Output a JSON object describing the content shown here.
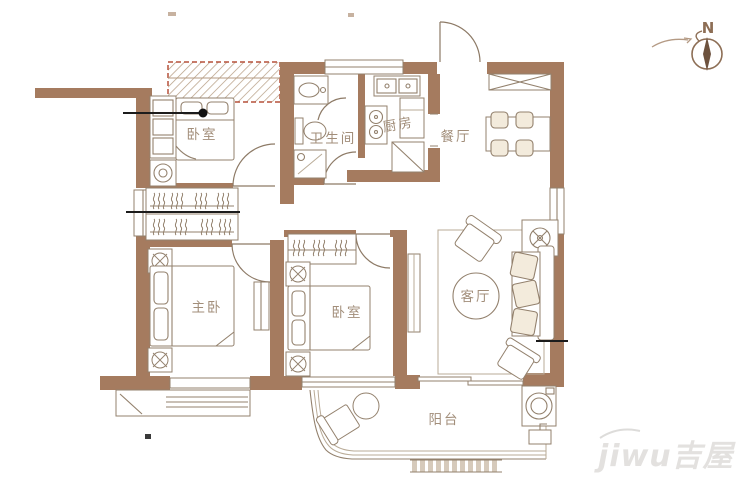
{
  "rooms": {
    "bedroom_top": {
      "label": "卧室"
    },
    "bathroom": {
      "label": "卫生间"
    },
    "kitchen": {
      "label": "厨房"
    },
    "dining": {
      "label": "餐厅"
    },
    "master_bedroom": {
      "label": "主卧"
    },
    "bedroom_middle": {
      "label": "卧室"
    },
    "living_room": {
      "label": "客厅"
    },
    "balcony": {
      "label": "阳台"
    }
  },
  "compass": {
    "north_label": "N"
  },
  "watermark": {
    "text": "jiwu吉屋"
  },
  "colors": {
    "wall": "#a57b5f",
    "furniture_line": "#93816d",
    "hatch_border": "#b5503a",
    "annotation_line": "#1c1c1c",
    "label_text": "#a28e7a",
    "watermark": "#e3e1df",
    "background": "#ffffff"
  }
}
